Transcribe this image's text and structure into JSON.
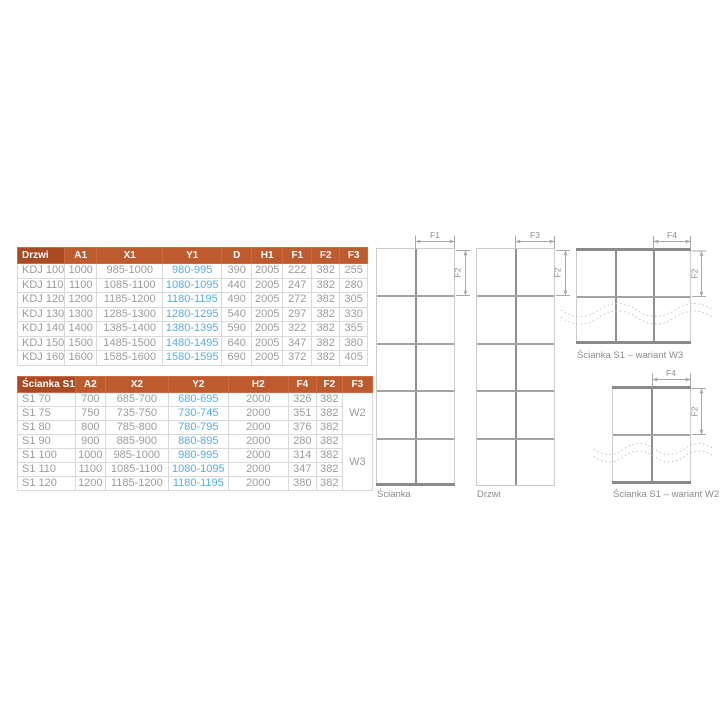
{
  "colors": {
    "header_bg": "#bd5a2e",
    "header_first_bg": "#a84a23",
    "header_text": "#ffffff",
    "data_text": "#9c9c9c",
    "highlight_text": "#55aee7",
    "cell_border": "#d9d9d9",
    "profile_gray": "#8a8a8a"
  },
  "drzwi_table": {
    "headers": [
      "Drzwi",
      "A1",
      "X1",
      "Y1",
      "D",
      "H1",
      "F1",
      "F2",
      "F3"
    ],
    "highlight_column": "Y1",
    "rows": [
      [
        "KDJ 100",
        "1000",
        "985-1000",
        "980-995",
        "390",
        "2005",
        "222",
        "382",
        "255"
      ],
      [
        "KDJ 110",
        "1100",
        "1085-1100",
        "1080-1095",
        "440",
        "2005",
        "247",
        "382",
        "280"
      ],
      [
        "KDJ 120",
        "1200",
        "1185-1200",
        "1180-1195",
        "490",
        "2005",
        "272",
        "382",
        "305"
      ],
      [
        "KDJ 130",
        "1300",
        "1285-1300",
        "1280-1295",
        "540",
        "2005",
        "297",
        "382",
        "330"
      ],
      [
        "KDJ 140",
        "1400",
        "1385-1400",
        "1380-1395",
        "590",
        "2005",
        "322",
        "382",
        "355"
      ],
      [
        "KDJ 150",
        "1500",
        "1485-1500",
        "1480-1495",
        "640",
        "2005",
        "347",
        "382",
        "380"
      ],
      [
        "KDJ 160",
        "1600",
        "1585-1600",
        "1580-1595",
        "690",
        "2005",
        "372",
        "382",
        "405"
      ]
    ]
  },
  "scianka_table": {
    "headers": [
      "Ścianka S1",
      "A2",
      "X2",
      "Y2",
      "H2",
      "F4",
      "F2",
      "F3"
    ],
    "highlight_column": "Y2",
    "rows": [
      [
        "S1 70",
        "700",
        "685-700",
        "680-695",
        "2000",
        "326",
        "382"
      ],
      [
        "S1 75",
        "750",
        "735-750",
        "730-745",
        "2000",
        "351",
        "382"
      ],
      [
        "S1 80",
        "800",
        "785-800",
        "780-795",
        "2000",
        "376",
        "382"
      ],
      [
        "S1 90",
        "900",
        "885-900",
        "880-895",
        "2000",
        "280",
        "382"
      ],
      [
        "S1 100",
        "1000",
        "985-1000",
        "980-995",
        "2000",
        "314",
        "382"
      ],
      [
        "S1 110",
        "1100",
        "1085-1100",
        "1080-1095",
        "2000",
        "347",
        "382"
      ],
      [
        "S1 120",
        "1200",
        "1185-1200",
        "1180-1195",
        "2000",
        "380",
        "382"
      ]
    ],
    "variant_groups": [
      {
        "label": "W2",
        "rows": 3
      },
      {
        "label": "W3",
        "rows": 4
      }
    ]
  },
  "diagrams": {
    "scianka": {
      "label": "Ścianka",
      "dim_top": "F1",
      "dim_side": "F2"
    },
    "drzwi": {
      "label": "Drzwi",
      "dim_top": "F3",
      "dim_side": "F2"
    },
    "wariant_w3": {
      "label": "Ścianka S1 – wariant W3",
      "dim_top": "F4",
      "dim_side": "F2"
    },
    "wariant_w2": {
      "label": "Ścianka S1 – wariant W2",
      "dim_top": "F4",
      "dim_side": "F2"
    }
  }
}
